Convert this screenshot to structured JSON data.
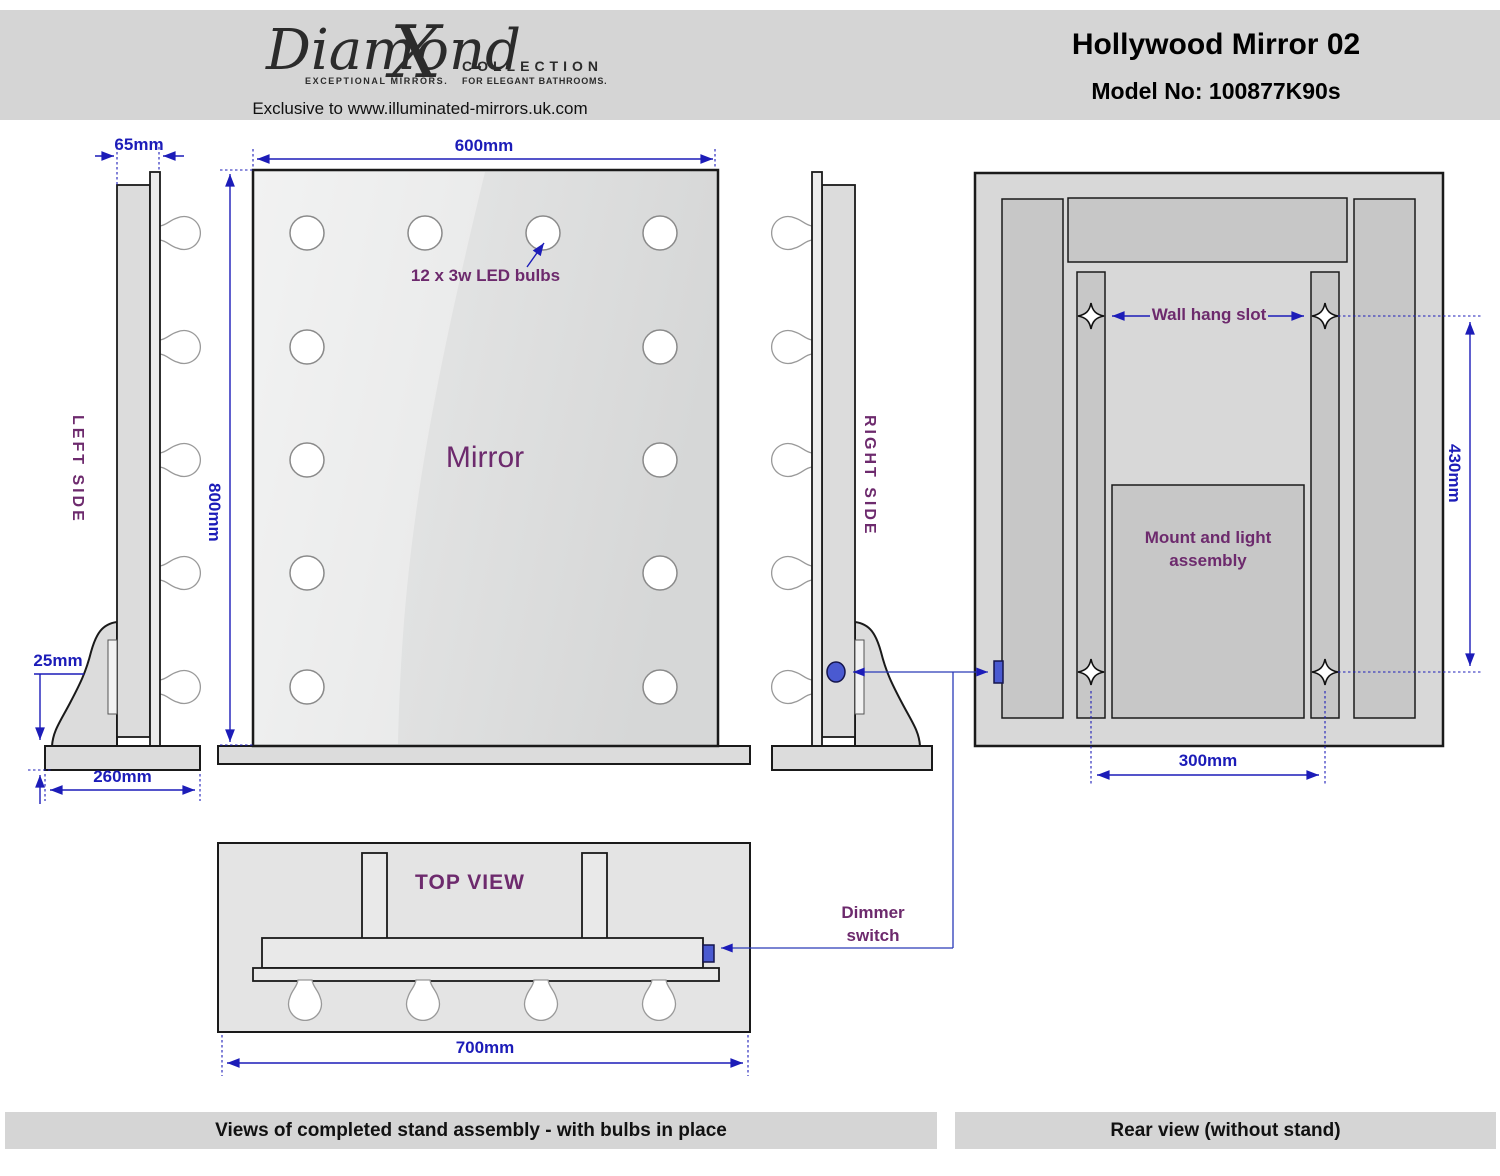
{
  "header": {
    "logo": {
      "script_main": "Diamond",
      "script_x": "X",
      "tagline_left": "EXCEPTIONAL MIRRORS.",
      "collection": "COLLECTION",
      "tagline_right": "FOR ELEGANT BATHROOMS.",
      "exclusive": "Exclusive to www.illuminated-mirrors.uk.com"
    },
    "title": "Hollywood Mirror 02",
    "model": "Model No: 100877K90s"
  },
  "labels": {
    "left_side": "LEFT SIDE",
    "right_side": "RIGHT SIDE",
    "mirror": "Mirror",
    "led_bulbs": "12 x 3w LED bulbs",
    "top_view": "TOP VIEW",
    "wall_hang_slot": "Wall hang slot",
    "mount_assembly": "Mount and light assembly",
    "dimmer_switch": "Dimmer switch"
  },
  "dimensions": {
    "frame_depth": "65mm",
    "mirror_width": "600mm",
    "mirror_height": "800mm",
    "base_thickness": "25mm",
    "base_depth": "260mm",
    "base_width": "700mm",
    "slot_vertical_spacing": "430mm",
    "slot_horizontal_spacing": "300mm"
  },
  "footer": {
    "left_caption": "Views of completed stand assembly - with bulbs in place",
    "right_caption": "Rear view (without stand)"
  },
  "colors": {
    "dimension_blue": "#1c1cb8",
    "label_purple": "#6d2a6d",
    "dimmer_blue": "#4a5ad1",
    "panel_gray": "#d5d5d5"
  }
}
